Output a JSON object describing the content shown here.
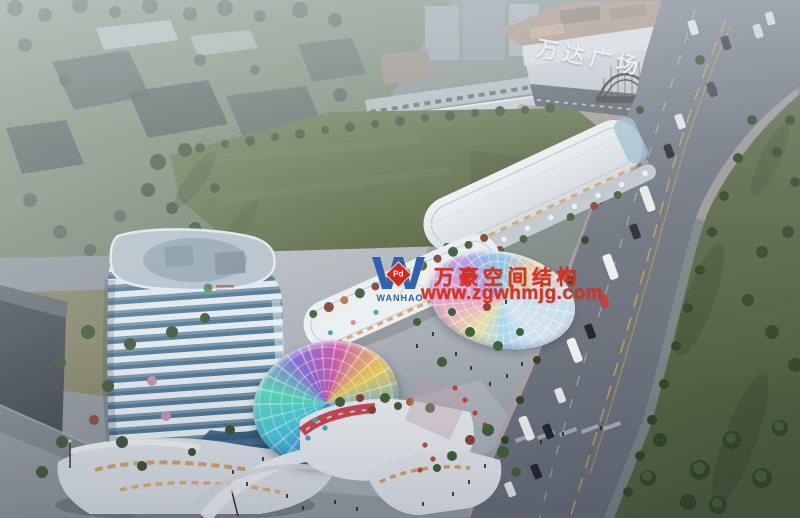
{
  "scene": {
    "description": "Aerial architectural rendering of a mixed-use commercial complex with curved tower, rainbow glass canopies and a large lawn beside Wanda Plaza",
    "signage": {
      "mall_sign": "万达广场"
    },
    "watermark": {
      "logo_letter": "W",
      "logo_badge": "Pd",
      "logo_name": "WANHAO",
      "line1": "万豪空间结构",
      "line2": "www.zgwhmjg.com"
    },
    "palette": {
      "watermark_red": "#e03020",
      "logo_blue": "#2e62b4",
      "lawn_green": "#5c6b40",
      "road_gray": "#6e7480",
      "tower_glass_blue": "#497391",
      "tower_band_white": "#e7edf1",
      "canopy_colors": [
        "#3a86d8",
        "#48c8e0",
        "#8a68d8",
        "#c858a8",
        "#e8c858"
      ]
    }
  }
}
